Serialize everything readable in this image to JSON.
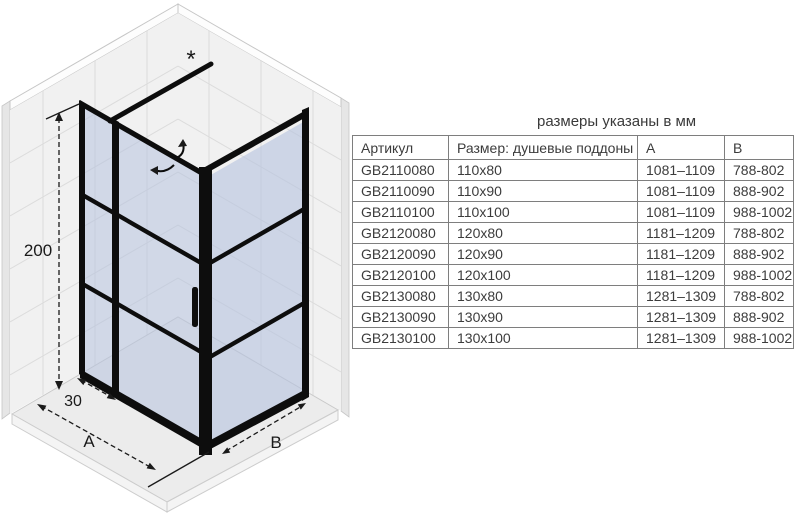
{
  "title": "размеры указаны в мм",
  "table": {
    "columns": [
      "Артикул",
      "Размер: душевые поддоны",
      "A",
      "B"
    ],
    "rows": [
      [
        "GB2110080",
        "110x80",
        "1081–1109",
        "788-802"
      ],
      [
        "GB2110090",
        "110x90",
        "1081–1109",
        "888-902"
      ],
      [
        "GB2110100",
        "110x100",
        "1081–1109",
        "988-1002"
      ],
      [
        "GB2120080",
        "120x80",
        "1181–1209",
        "788-802"
      ],
      [
        "GB2120090",
        "120x90",
        "1181–1209",
        "888-902"
      ],
      [
        "GB2120100",
        "120x100",
        "1181–1209",
        "988-1002"
      ],
      [
        "GB2130080",
        "130x80",
        "1281–1309",
        "788-802"
      ],
      [
        "GB2130090",
        "130x90",
        "1281–1309",
        "888-902"
      ],
      [
        "GB2130100",
        "130x100",
        "1281–1309",
        "988-1002"
      ]
    ]
  },
  "diagram": {
    "labels": {
      "height": "200",
      "panel_width": "30",
      "width_a": "A",
      "depth_b": "B",
      "asterisk": "*"
    },
    "colors": {
      "frame": "#0d0d0d",
      "glass": "#b7c3de",
      "wall": "#f1f1f1",
      "tile": "#dcdcdc",
      "floor": "#ececec",
      "dim": "#1a1a1a"
    }
  }
}
